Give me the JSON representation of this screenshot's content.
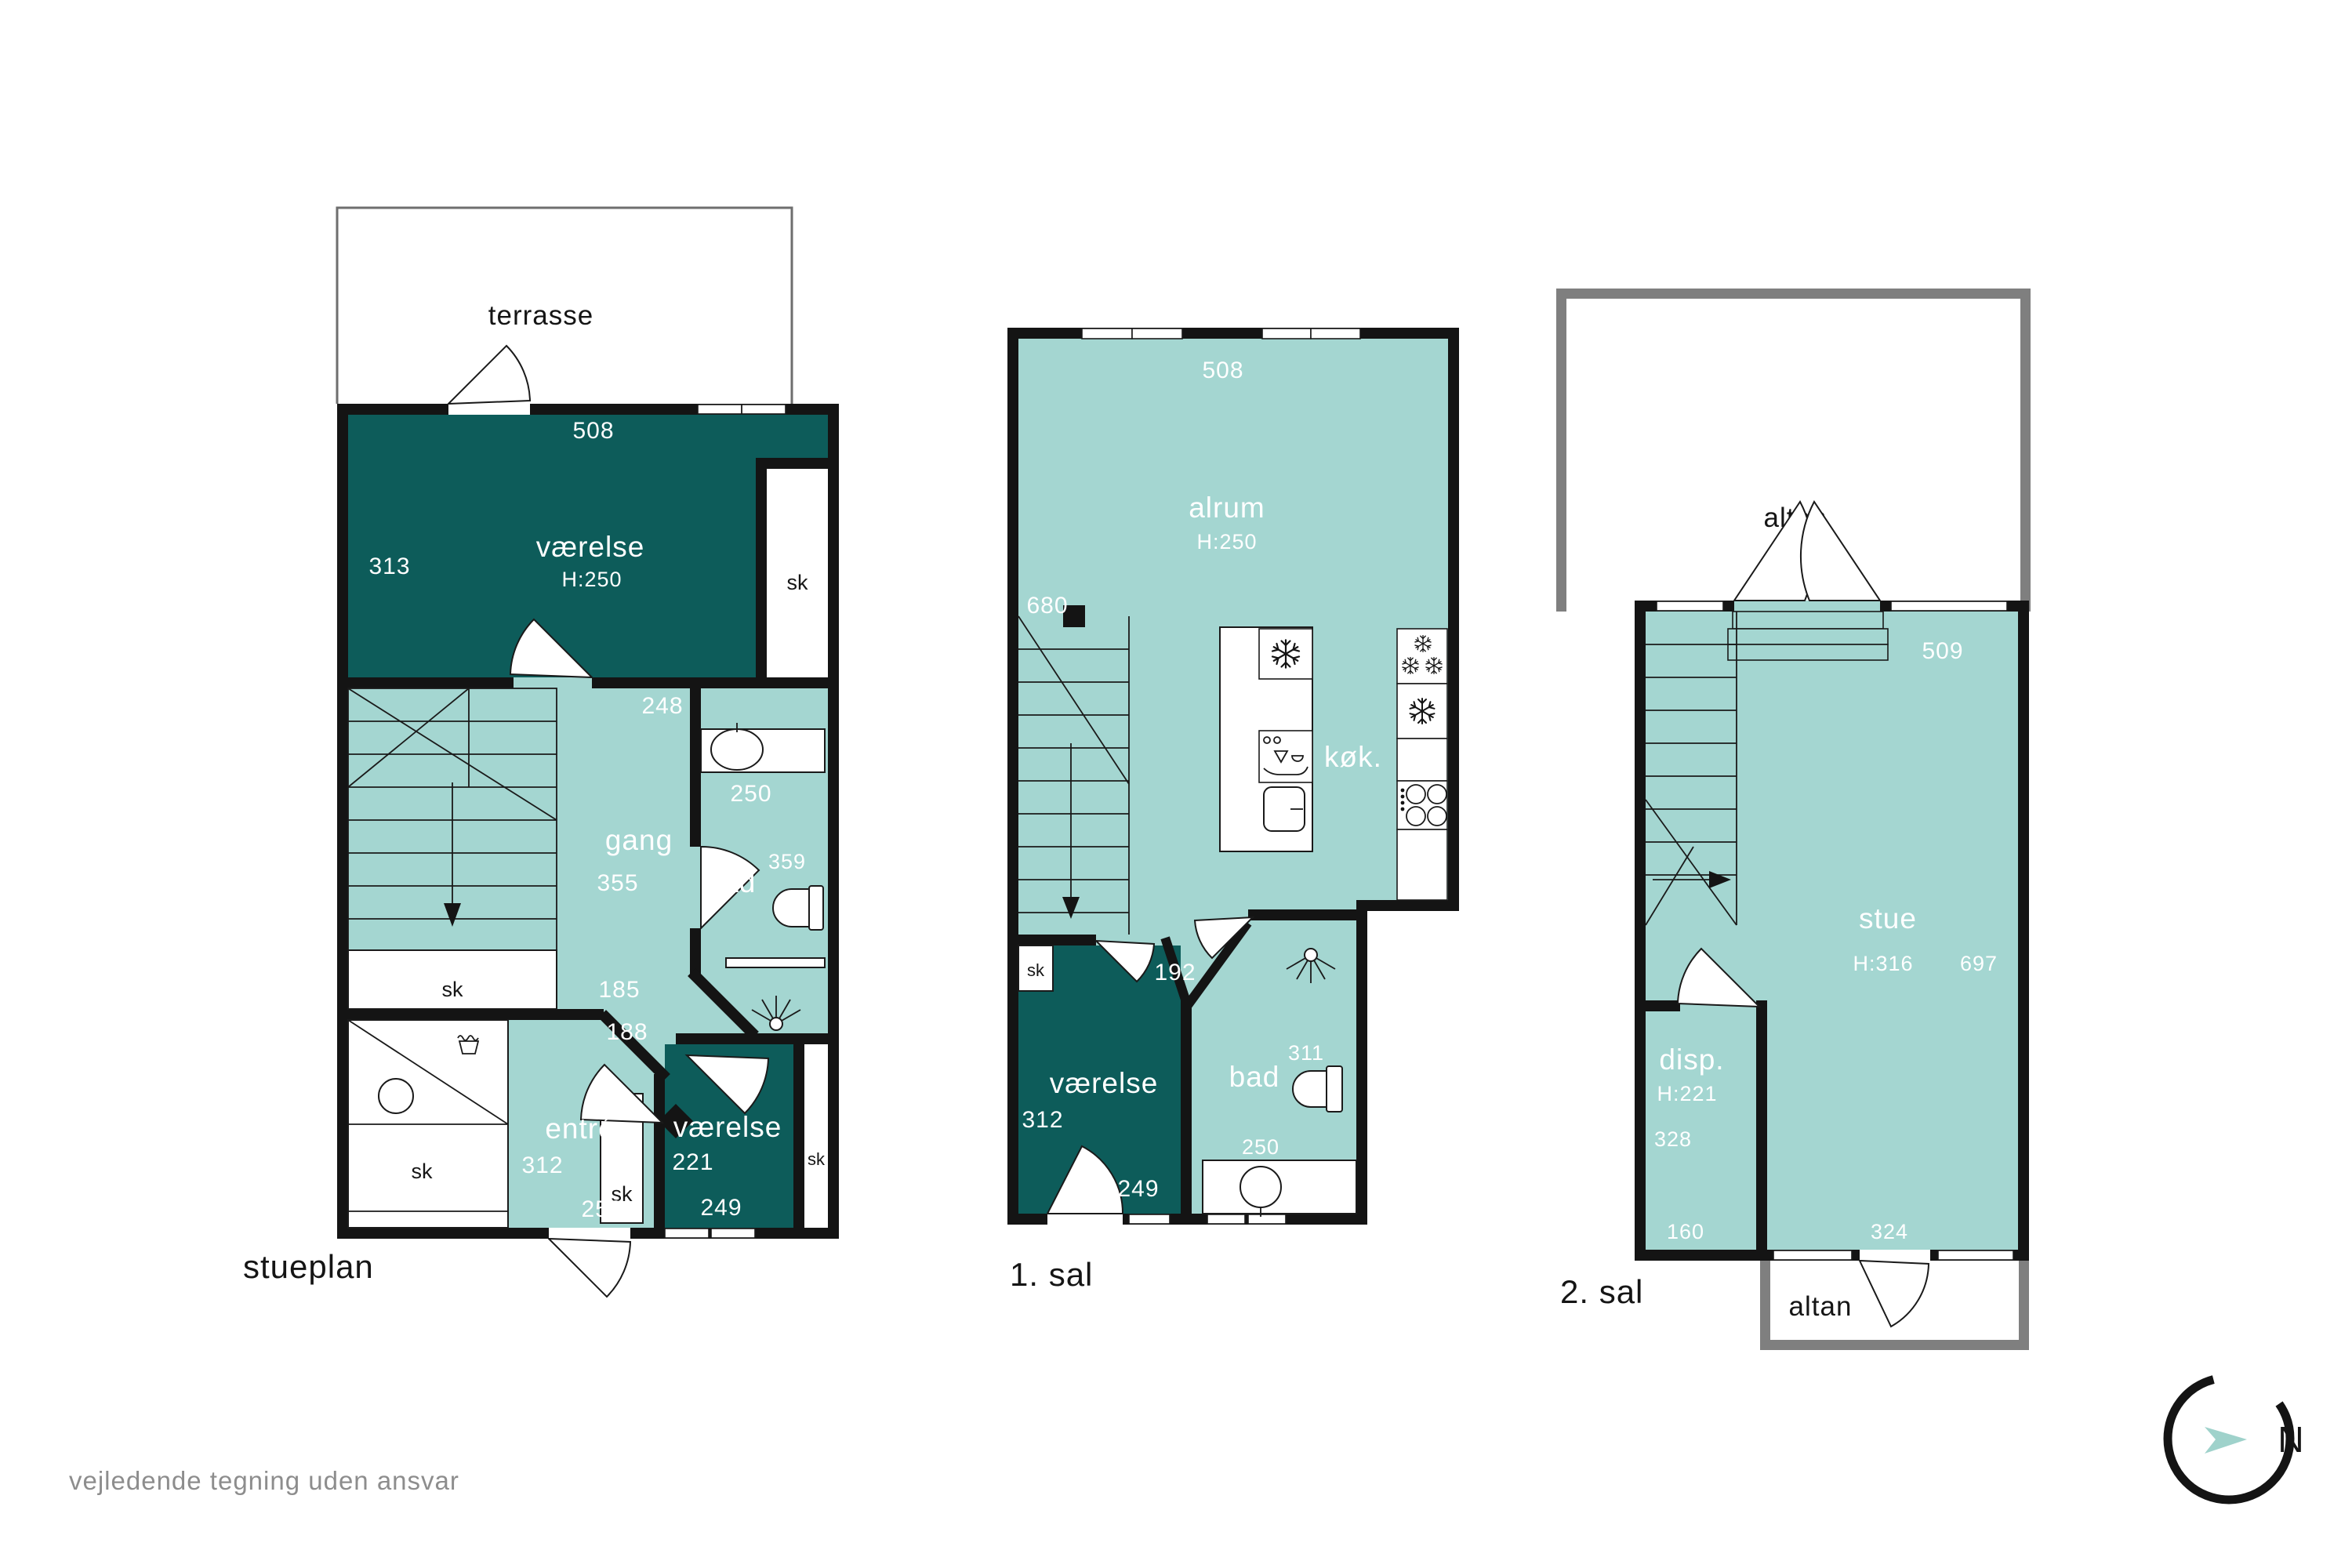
{
  "colors": {
    "room_dark": "#0d5c5a",
    "room_light": "#a4d6d1",
    "wall": "#141414",
    "altan_border": "#7f7f7f",
    "muted_text": "#8d8d8d",
    "compass_arrow": "#9fd2cb"
  },
  "stueplan": {
    "label": "stueplan",
    "terrasse": "terrasse",
    "sk": "sk",
    "vaerelse1": {
      "name": "værelse",
      "height": "H:250",
      "w": "508",
      "d": "313"
    },
    "gang": {
      "name": "gang",
      "d": "355",
      "w": "248",
      "dim1": "185",
      "dim2": "188"
    },
    "bad": {
      "name": "bad",
      "w": "250",
      "d": "359"
    },
    "entre": {
      "name": "entré",
      "d": "312",
      "w": "250"
    },
    "vaerelse2": {
      "name": "værelse",
      "d": "221",
      "w": "249"
    }
  },
  "sal1": {
    "label": "1. sal",
    "sk": "sk",
    "alrum": {
      "name": "alrum",
      "height": "H:250",
      "w": "508",
      "d": "680"
    },
    "kok": {
      "name": "køk."
    },
    "corridor": "192",
    "vaerelse": {
      "name": "værelse",
      "d": "312",
      "w": "249"
    },
    "bad": {
      "name": "bad",
      "d": "311",
      "w": "250"
    }
  },
  "sal2": {
    "label": "2. sal",
    "altan_top": "altan",
    "altan_bottom": "altan",
    "stue": {
      "name": "stue",
      "height": "H:316",
      "d": "697",
      "w_top": "509",
      "w_bottom": "324"
    },
    "disp": {
      "name": "disp.",
      "height": "H:221",
      "d": "328",
      "w": "160"
    }
  },
  "footer": {
    "disclaimer": "vejledende tegning uden ansvar"
  },
  "compass": {
    "north": "N"
  }
}
